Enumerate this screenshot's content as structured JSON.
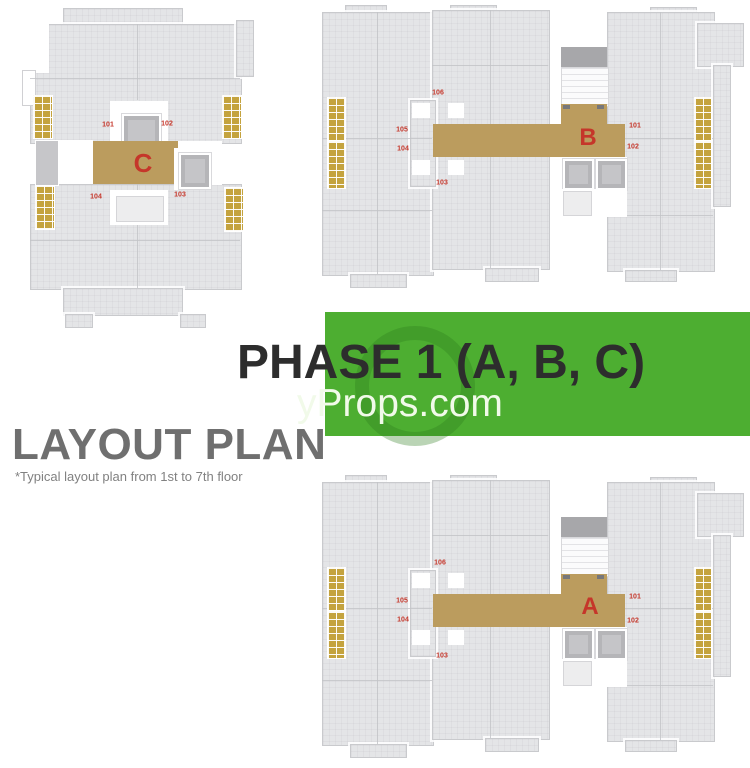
{
  "banner": {
    "title": "PHASE 1  (A, B, C)"
  },
  "watermark": {
    "text": "yProps.com"
  },
  "heading": {
    "title": "LAYOUT PLAN",
    "subtitle": "*Typical layout plan from 1st to 7th floor"
  },
  "plans": {
    "c": {
      "letter": "C",
      "units": {
        "u101": "101",
        "u102": "102",
        "u103": "103",
        "u104": "104"
      }
    },
    "b": {
      "letter": "B",
      "units": {
        "u101": "101",
        "u102": "102",
        "u103": "103",
        "u104": "104",
        "u105": "105",
        "u106": "106"
      }
    },
    "a": {
      "letter": "A",
      "units": {
        "u101": "101",
        "u102": "102",
        "u103": "103",
        "u104": "104",
        "u105": "105",
        "u106": "106"
      }
    }
  },
  "colors": {
    "banner_green": "#4dae31",
    "title_text": "#2d2d2d",
    "heading_gray": "#6f6f6f",
    "subtitle_gray": "#818181",
    "floor": "#e4e5e7",
    "wall_line": "#c2c3c7",
    "corridor_tan": "#bb9c5e",
    "balcony_gold": "#c4a33e",
    "lift_gray": "#b5b5b8",
    "stair_gray": "#a7a7aa",
    "unit_red": "#c5362a",
    "watermark": "#f1fae9"
  }
}
